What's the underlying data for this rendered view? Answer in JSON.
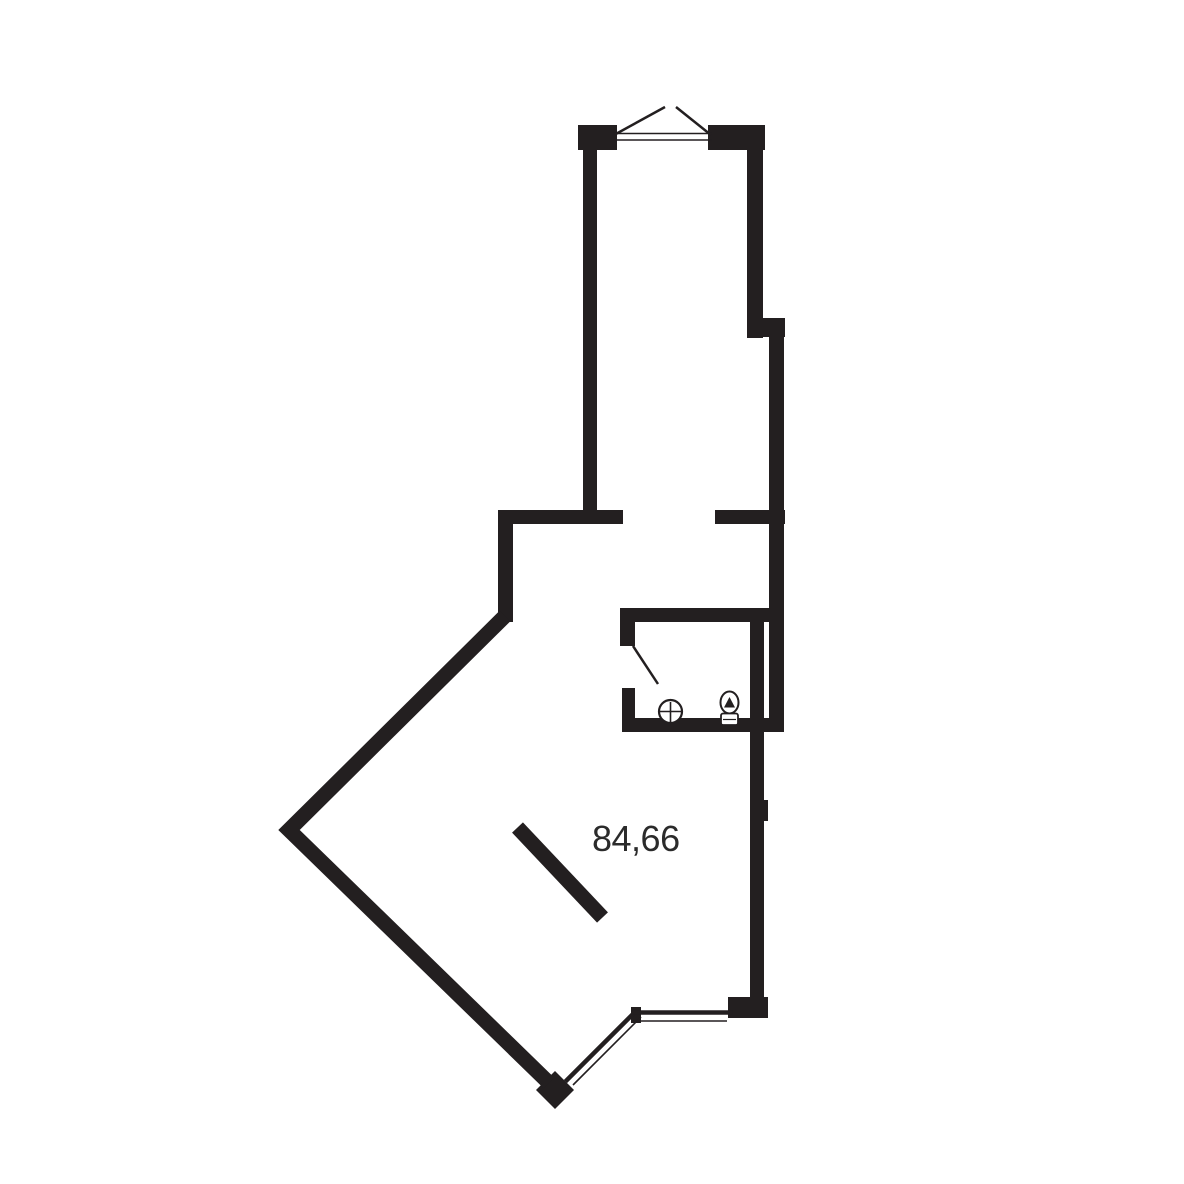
{
  "colors": {
    "wall": "#231f20",
    "label": "#2b2b2b",
    "background": "#ffffff"
  },
  "plan": {
    "area_label": "84,66",
    "icons": {
      "entrance": "double-door-swing-icon",
      "bathroom_door": "door-swing-icon",
      "fixtures": [
        "sink-icon",
        "toilet-icon"
      ],
      "glazing": [
        "diagonal-window",
        "bottom-window"
      ]
    }
  }
}
